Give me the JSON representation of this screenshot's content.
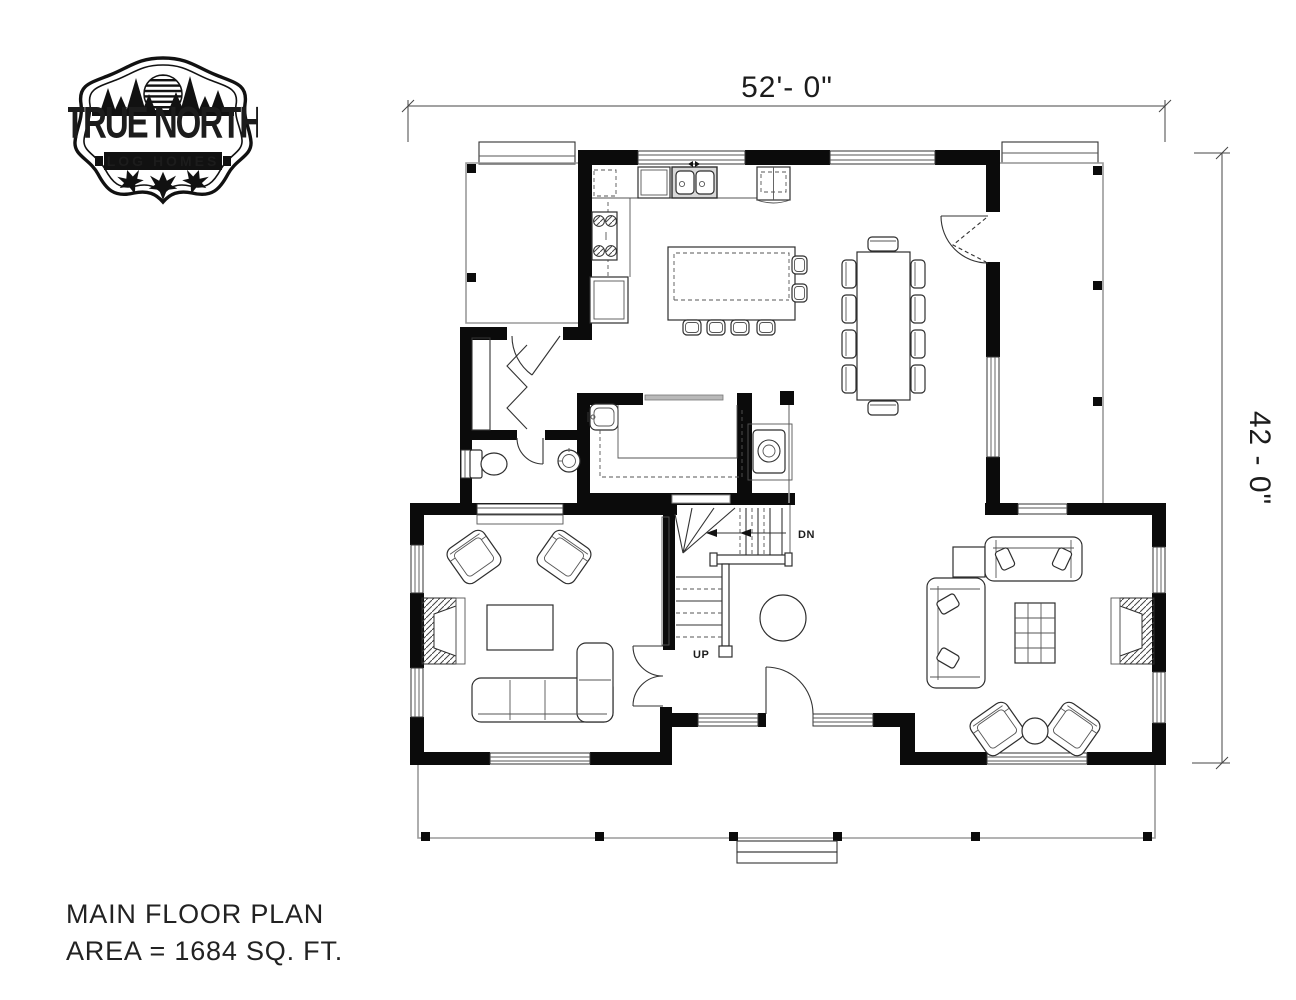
{
  "logo": {
    "name": "true-north-log-homes-badge",
    "line1": "TRUE NORTH",
    "line2": "LOG HOMES",
    "motifs": [
      "pine-trees-icon",
      "striped-sun-icon",
      "maple-leaf-icon"
    ]
  },
  "dimensions": {
    "overall_width": "52'- 0\"",
    "overall_depth": "42 - 0\""
  },
  "plan": {
    "stair_down_label": "DN",
    "stair_up_label": "UP",
    "icons": [
      "kitchen-sink-icon",
      "refrigerator-icon",
      "range-cooktop-icon",
      "kitchen-island-icon",
      "bar-stool-icon",
      "dining-table-icon",
      "dining-chair-icon",
      "wood-stove-icon",
      "staircase-icon",
      "round-table-icon",
      "toilet-icon",
      "pedestal-sink-icon",
      "laundry-tub-icon",
      "closet-icon",
      "bifold-door-icon",
      "door-swing-icon",
      "armchair-icon",
      "fireplace-icon",
      "coffee-table-icon",
      "sectional-sofa-icon",
      "sofa-icon",
      "ottoman-icon",
      "side-table-icon",
      "porch-post-icon",
      "porch-steps-icon",
      "window-icon"
    ]
  },
  "title_block": {
    "line1": "MAIN FLOOR PLAN",
    "line2": "AREA = 1684 SQ. FT."
  },
  "colors": {
    "background": "#ffffff",
    "wall": "#0b0b0b",
    "line": "#333333",
    "light_line": "#9a9a9a",
    "text": "#1c1c1c"
  }
}
